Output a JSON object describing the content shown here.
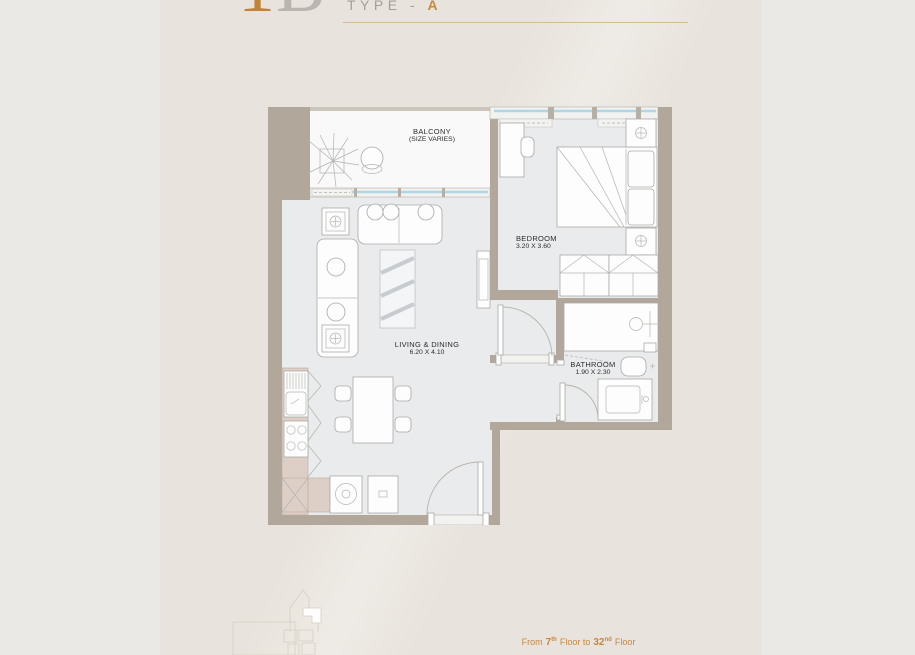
{
  "page": {
    "background": "#e8e3dc",
    "margin_background": "#ebe9e6",
    "accent_gold": "#c8883c"
  },
  "header": {
    "plan_code": "1B",
    "plan_code_first": "1",
    "plan_code_rest": "B",
    "type_prefix": "TYPE - ",
    "type_letter": "A"
  },
  "floorplan": {
    "rooms": [
      {
        "name": "balcony",
        "label": "BALCONY",
        "sublabel": "(SIZE VARIES)"
      },
      {
        "name": "bedroom",
        "label": "BEDROOM",
        "dimensions": "3.20 X 3.60"
      },
      {
        "name": "living-dining",
        "label": "LIVING & DINING",
        "dimensions": "6.20 X 4.10"
      },
      {
        "name": "bathroom",
        "label": "BATHROOM",
        "dimensions": "1.90 X 2.30"
      }
    ],
    "icons": [
      "plant-icon",
      "balcony-chair-icon",
      "sofa-icon",
      "lamp-table-icon",
      "rug-icon",
      "tv-unit-icon",
      "dining-table-icon",
      "bed-icon",
      "desk-icon",
      "nightstand-lamp-icon",
      "wardrobe-icon",
      "shower-icon",
      "toilet-icon",
      "vanity-icon",
      "kitchen-sink-icon",
      "hob-icon",
      "washing-machine-icon",
      "water-heater-icon",
      "shaft-icon",
      "door-swing-icon"
    ],
    "colors": {
      "wall": "#b2a79b",
      "floor": "#e9ebed",
      "balcony_floor": "#f8f9f8",
      "cabinet": "#ddcfc5",
      "glass": "#aed6e6"
    }
  },
  "footer": {
    "from_word": "From",
    "start_floor": "7",
    "start_suffix": "th",
    "middle_text": "Floor to",
    "end_floor": "32",
    "end_suffix": "nd",
    "end_word": "Floor"
  }
}
